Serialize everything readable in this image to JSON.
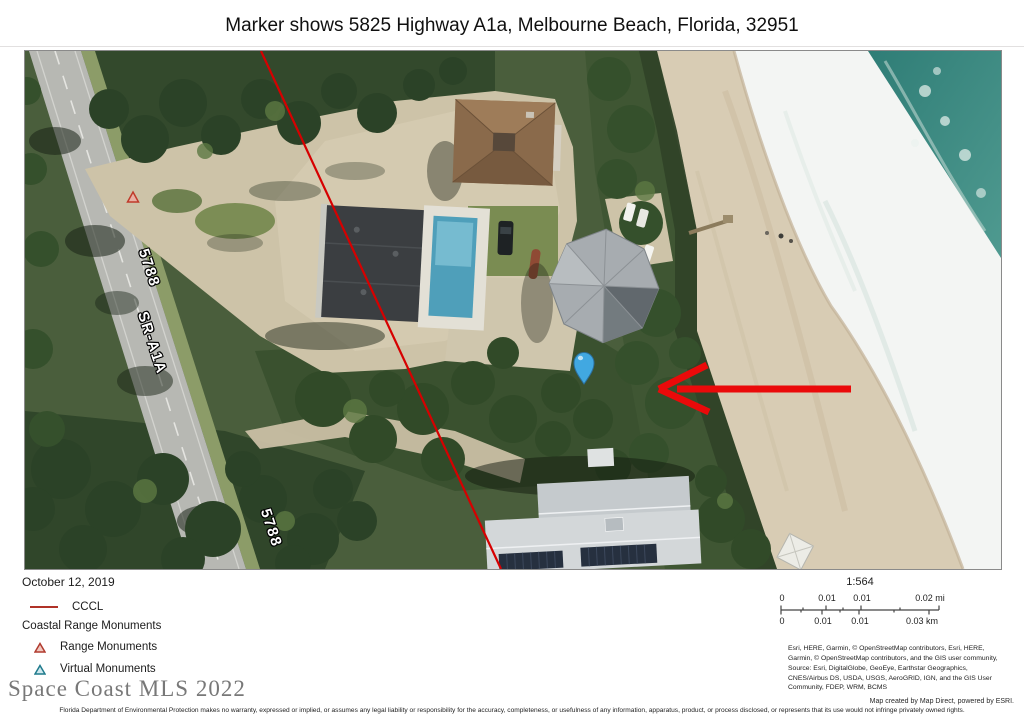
{
  "title": "Marker shows 5825 Highway A1a, Melbourne Beach, Florida, 32951",
  "map": {
    "road_label_top": "5788",
    "road_name_label": "SR-A1A",
    "road_label_bottom": "5788",
    "marker_color": "#41a8e1",
    "arrow_color": "#ea0a0a",
    "cccl_color": "#d60000",
    "ocean_color": "#3f8d85",
    "sand_color": "#d8ccb4"
  },
  "legend": {
    "date": "October 12, 2019",
    "cccl_label": "CCCL",
    "group_title": "Coastal Range Monuments",
    "range_label": "Range Monuments",
    "virtual_label": "Virtual Monuments"
  },
  "scale": {
    "ratio": "1:564",
    "mi": [
      "0",
      "0.01",
      "0.01",
      "0.02 mi"
    ],
    "km": [
      "0",
      "0.01",
      "0.01",
      "0.03 km"
    ]
  },
  "attribution": "Esri, HERE, Garmin, © OpenStreetMap contributors, Esri, HERE, Garmin, © OpenStreetMap contributors, and the GIS user community, Source: Esri, DigitalGlobe, GeoEye, Earthstar Geographics, CNES/Airbus DS, USDA, USGS, AeroGRID, IGN, and the GIS User Community, FDEP, WRM, BCMS",
  "watermark": "Space Coast MLS 2022",
  "footer": {
    "credit": "Map created by Map Direct, powered by ESRI.",
    "disclaimer": "Florida Department of Environmental Protection makes no warranty, expressed or implied, or assumes any legal liability or responsibility for the accuracy, completeness, or usefulness of any information, apparatus, product, or process disclosed, or represents that its use would not infringe privately owned rights."
  }
}
